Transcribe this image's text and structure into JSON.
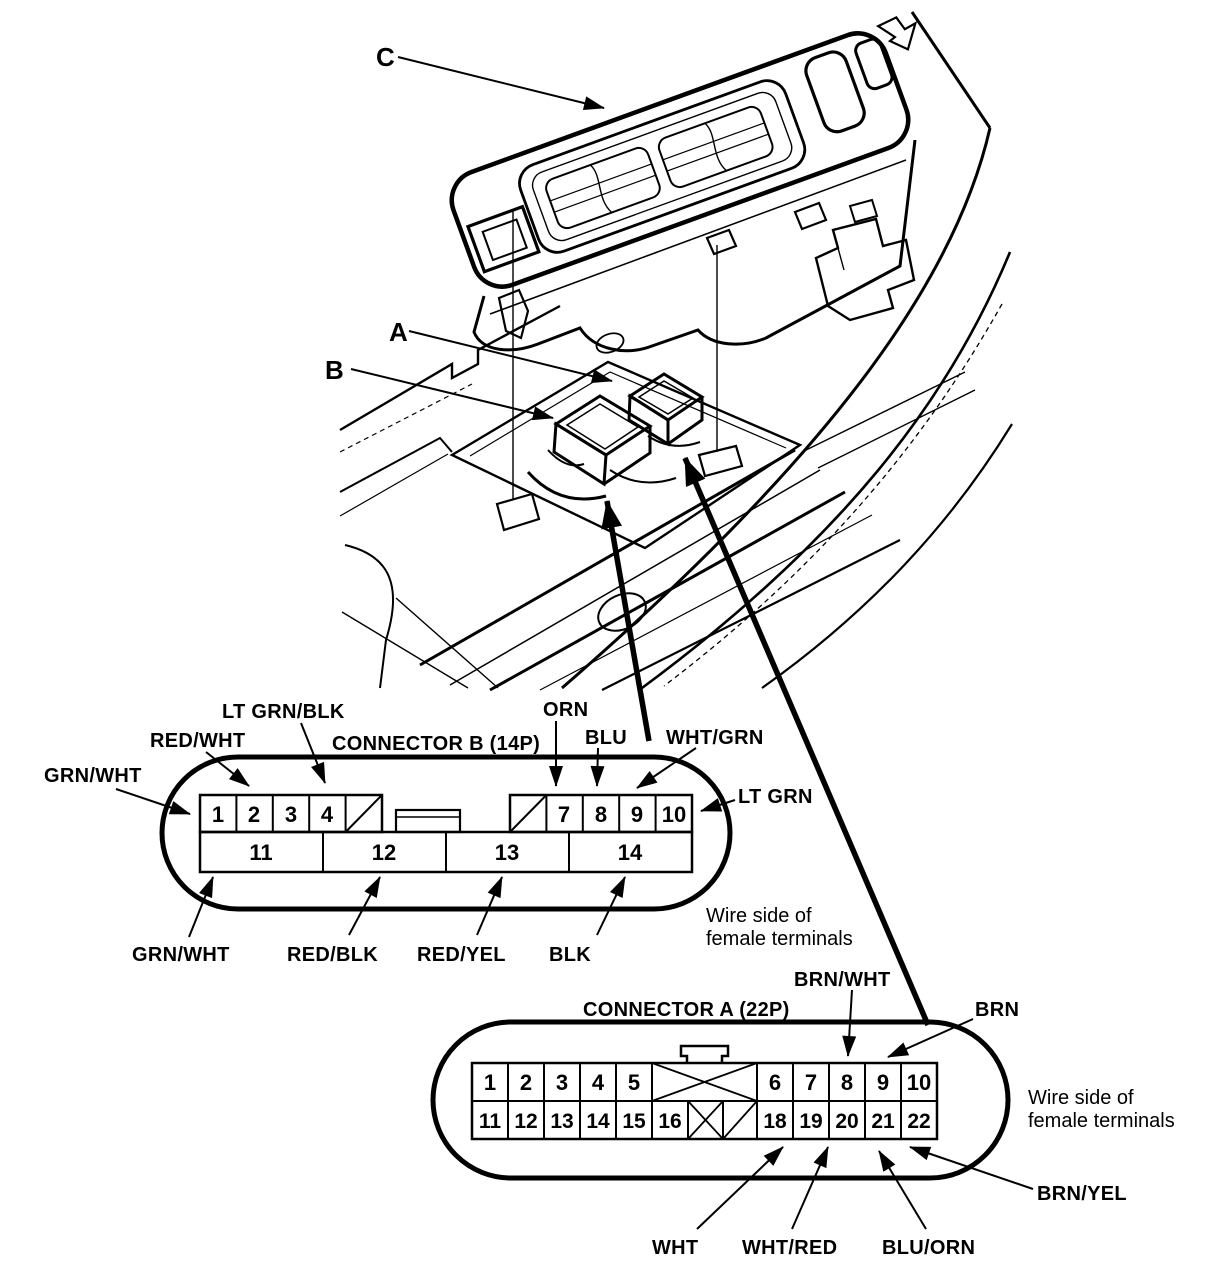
{
  "callouts": {
    "c": "C",
    "a": "A",
    "b": "B"
  },
  "connector_b": {
    "title": "CONNECTOR B (14P)",
    "top_pins": [
      "1",
      "2",
      "3",
      "4",
      "7",
      "8",
      "9",
      "10"
    ],
    "bottom_pins": [
      "11",
      "12",
      "13",
      "14"
    ],
    "labels": {
      "grn_wht_top": "GRN/WHT",
      "red_wht": "RED/WHT",
      "lt_grn_blk": "LT GRN/BLK",
      "orn": "ORN",
      "blu": "BLU",
      "wht_grn": "WHT/GRN",
      "lt_grn": "LT GRN",
      "grn_wht_bottom": "GRN/WHT",
      "red_blk": "RED/BLK",
      "red_yel": "RED/YEL",
      "blk": "BLK"
    },
    "note_line1": "Wire side of",
    "note_line2": "female terminals"
  },
  "connector_a": {
    "title": "CONNECTOR A (22P)",
    "top_pins": [
      "1",
      "2",
      "3",
      "4",
      "5",
      "6",
      "7",
      "8",
      "9",
      "10"
    ],
    "bottom_pins": [
      "11",
      "12",
      "13",
      "14",
      "15",
      "16",
      "18",
      "19",
      "20",
      "21",
      "22"
    ],
    "labels": {
      "brn_wht": "BRN/WHT",
      "brn": "BRN",
      "brn_yel": "BRN/YEL",
      "wht": "WHT",
      "wht_red": "WHT/RED",
      "blu_orn": "BLU/ORN"
    },
    "note_line1": "Wire side of",
    "note_line2": "female terminals"
  }
}
